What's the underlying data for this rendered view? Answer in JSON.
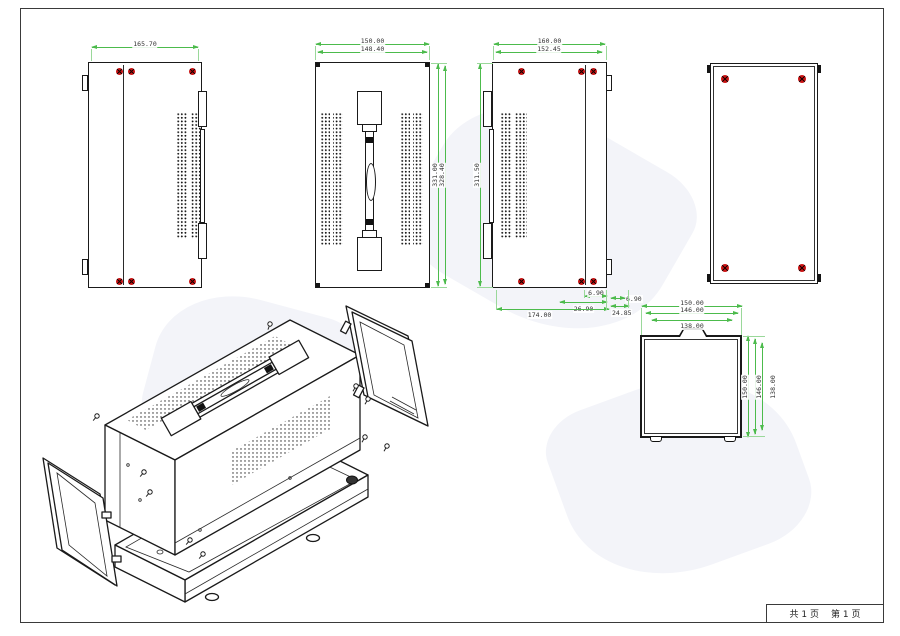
{
  "colors": {
    "dimension_line": "#4cbb4c",
    "object_line": "#1a1a1a",
    "screw_red": "#cc1414"
  },
  "dims": {
    "side_panel_width": "165.70",
    "top_panel_width_outer": "150.00",
    "top_panel_width_inner": "148.40",
    "top_panel_height_outer": "331.00",
    "top_panel_height_inner": "328.40",
    "vent_panel_width_outer": "160.00",
    "vent_panel_width_inner": "152.45",
    "vent_panel_height": "311.50",
    "vent_panel_bottom_overall": "174.00",
    "vent_panel_bottom_mid": "26.90",
    "vent_panel_bottom_small": "6.90",
    "vent_panel_bottom_right_top": "6.90",
    "vent_panel_bottom_right_bottom": "24.85",
    "front_panel_top_1": "150.00",
    "front_panel_top_2": "146.00",
    "front_panel_top_3": "138.00",
    "front_panel_right_1": "150.00",
    "front_panel_right_2": "146.00",
    "front_panel_right_3": "138.00"
  },
  "footer": {
    "total_pages": "共 1 页",
    "current_page": "第 1 页"
  }
}
